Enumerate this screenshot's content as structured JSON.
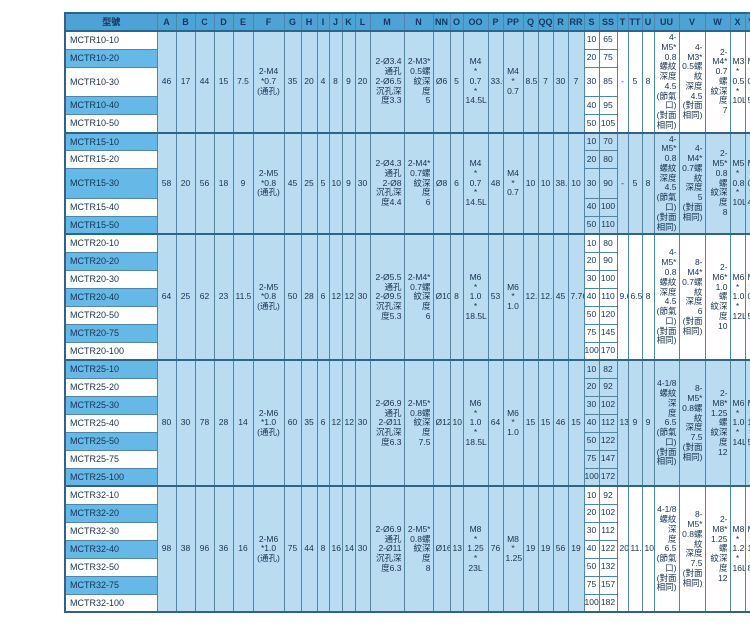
{
  "colors": {
    "header_bg": "#4da3d6",
    "model_row_blue": "#66b9e6",
    "cell_light_blue": "#b9dcf0",
    "cell_white": "#ffffff",
    "border": "#4f85a6",
    "outer_border": "#2f6486",
    "text": "#16324f"
  },
  "table": {
    "model_header": "型號",
    "letter_columns": [
      "A",
      "B",
      "C",
      "D",
      "E",
      "F",
      "G",
      "H",
      "I",
      "J",
      "K",
      "L",
      "M",
      "N",
      "NN",
      "O",
      "OO",
      "P",
      "PP",
      "Q",
      "QQ",
      "R",
      "RR",
      "S",
      "SS",
      "T",
      "TT",
      "U",
      "UU",
      "V",
      "W",
      "X",
      "Y",
      "Z",
      "ZZ"
    ],
    "blocks": [
      {
        "band": "white",
        "shared": {
          "A": "46",
          "B": "17",
          "C": "44",
          "D": "15",
          "E": "7.5",
          "F": "2-M4\n*0.7\n(通孔)",
          "G": "35",
          "H": "20",
          "I": "4",
          "J": "8",
          "K": "9",
          "L": "20",
          "M": "2-Ø3.4\n通孔\n2-Ø6.5\n沉孔深\n度3.3",
          "N": "2-M3*\n0.5螺\n紋深度\n5",
          "NN": "Ø6",
          "O": "5",
          "OO": "M4\n*\n0.7\n*\n14.5L",
          "P": "33.6",
          "PP": "M4\n*\n0.7",
          "Q": "8.5",
          "QQ": "7",
          "R": "30",
          "RR": "7",
          "T": "-",
          "TT": "5",
          "U": "8",
          "UU": "4-M5*\n0.8螺紋\n深度4.5\n(節氣\n口)\n(對面\n相同)",
          "V": "4-M3*\n0.5螺紋\n深度4.5\n(對面\n相同)",
          "W": "2-M4*\n0.7螺\n紋深度\n7",
          "X": "M3\n*\n0.5\n*\n10L",
          "Y": "M3\n*\n0.5\n*\n5L"
        },
        "z_groups": [
          {
            "value": "30",
            "span": 2
          },
          {
            "value": "40",
            "span": 3
          }
        ],
        "rows": [
          {
            "model": "MCTR10-10",
            "S": "10",
            "SS": "65",
            "ZZ": "82"
          },
          {
            "model": "MCTR10-20",
            "S": "20",
            "SS": "75",
            "ZZ": "92"
          },
          {
            "model": "MCTR10-30",
            "S": "30",
            "SS": "85",
            "ZZ": "102"
          },
          {
            "model": "MCTR10-40",
            "S": "40",
            "SS": "95",
            "ZZ": "112"
          },
          {
            "model": "MCTR10-50",
            "S": "50",
            "SS": "105",
            "ZZ": "122"
          }
        ]
      },
      {
        "band": "blue",
        "shared": {
          "A": "58",
          "B": "20",
          "C": "56",
          "D": "18",
          "E": "9",
          "F": "2-M5\n*0.8\n(通孔)",
          "G": "45",
          "H": "25",
          "I": "5",
          "J": "10",
          "K": "9",
          "L": "30",
          "M": "2-Ø4.3\n通孔\n2-Ø8\n沉孔深\n度4.4",
          "N": "2-M4*\n0.7螺\n紋深度\n6",
          "NN": "Ø8",
          "O": "6",
          "OO": "M4\n*\n0.7\n*\n14.5L",
          "P": "48",
          "PP": "M4\n*\n0.7",
          "Q": "10",
          "QQ": "10",
          "R": "38.5",
          "RR": "10",
          "T": "-",
          "TT": "5",
          "U": "8",
          "UU": "4-M5*\n0.8螺紋\n深度4.5\n(節氣\n口)\n(對面\n相同)",
          "V": "4-M4*\n0.7螺紋\n深度5\n(對面\n相同)",
          "W": "2-M5*\n0.8螺\n紋深度\n8",
          "X": "M5\n*\n0.8\n*\n10L",
          "Y": "M4\n*\n0.7\n*\n4L"
        },
        "z_groups": [
          {
            "value": "25",
            "span": 2
          },
          {
            "value": "35",
            "span": 3
          }
        ],
        "rows": [
          {
            "model": "MCTR15-10",
            "S": "10",
            "SS": "70",
            "ZZ": "89"
          },
          {
            "model": "MCTR15-20",
            "S": "20",
            "SS": "80",
            "ZZ": "99"
          },
          {
            "model": "MCTR15-30",
            "S": "30",
            "SS": "90",
            "ZZ": "109"
          },
          {
            "model": "MCTR15-40",
            "S": "40",
            "SS": "100",
            "ZZ": "119"
          },
          {
            "model": "MCTR15-50",
            "S": "50",
            "SS": "110",
            "ZZ": "129"
          }
        ]
      },
      {
        "band": "white",
        "shared": {
          "A": "64",
          "B": "25",
          "C": "62",
          "D": "23",
          "E": "11.5",
          "F": "2-M5\n*0.8\n(通孔)",
          "G": "50",
          "H": "28",
          "I": "6",
          "J": "12",
          "K": "12",
          "L": "30",
          "M": "2-Ø5.5\n通孔\n2-Ø9.5\n沉孔深\n度5.3",
          "N": "2-M4*\n0.7螺\n紋深度\n6",
          "NN": "Ø10",
          "O": "8",
          "OO": "M6\n*\n1.0\n*\n18.5L",
          "P": "53",
          "PP": "M6\n*\n1.0",
          "Q": "12.5",
          "QQ": "12.5",
          "R": "45",
          "RR": "7.76",
          "T": "9.6",
          "TT": "6.5",
          "U": "8",
          "UU": "4-M5*\n0.8螺紋\n深度4.5\n(節氣\n口)\n(對面\n相同)",
          "V": "8-M4*\n0.7螺紋\n深度6\n(對面\n相同)",
          "W": "2-M6*\n1.0螺\n紋深度\n10",
          "X": "M6\n*\n1.0\n*\n12L",
          "Y": "M5\n*\n0.8\n*\n5L"
        },
        "z_groups": [
          {
            "value": "30",
            "span": 2
          },
          {
            "value": "40",
            "span": 3
          },
          {
            "value": "60",
            "span": 2
          }
        ],
        "rows": [
          {
            "model": "MCTR20-10",
            "S": "10",
            "SS": "80",
            "ZZ": "104"
          },
          {
            "model": "MCTR20-20",
            "S": "20",
            "SS": "90",
            "ZZ": "114"
          },
          {
            "model": "MCTR20-30",
            "S": "30",
            "SS": "100",
            "ZZ": "124"
          },
          {
            "model": "MCTR20-40",
            "S": "40",
            "SS": "110",
            "ZZ": "134"
          },
          {
            "model": "MCTR20-50",
            "S": "50",
            "SS": "120",
            "ZZ": "144"
          },
          {
            "model": "MCTR20-75",
            "S": "75",
            "SS": "145",
            "ZZ": "169"
          },
          {
            "model": "MCTR20-100",
            "S": "100",
            "SS": "170",
            "ZZ": "194"
          }
        ]
      },
      {
        "band": "blue",
        "shared": {
          "A": "80",
          "B": "30",
          "C": "78",
          "D": "28",
          "E": "14",
          "F": "2-M6\n*1.0\n(通孔)",
          "G": "60",
          "H": "35",
          "I": "6",
          "J": "12",
          "K": "12",
          "L": "30",
          "M": "2-Ø6.9\n通孔\n2-Ø11\n沉孔深\n度6.3",
          "N": "2-M5*\n0.8螺\n紋深度\n7.5",
          "NN": "Ø12",
          "O": "10",
          "OO": "M6\n*\n1.0\n*\n18.5L",
          "P": "64",
          "PP": "M6\n*\n1.0",
          "Q": "15",
          "QQ": "15",
          "R": "46",
          "RR": "15",
          "T": "13",
          "TT": "9",
          "U": "9",
          "UU": "4-1/8\n螺紋深\n度6.5\n(節氣\n口)\n(對面\n相同)",
          "V": "8-M5*\n0.8螺紋\n深度7.5\n(對面\n相同)",
          "W": "2-M8*\n1.25螺\n紋深度\n12",
          "X": "M6\n*\n1.0\n*\n14L",
          "Y": "M6\n*\n1.0\n*\n5L"
        },
        "z_groups": [
          {
            "value": "30",
            "span": 2
          },
          {
            "value": "40",
            "span": 3
          },
          {
            "value": "60",
            "span": 2
          }
        ],
        "rows": [
          {
            "model": "MCTR25-10",
            "S": "10",
            "SS": "82",
            "ZZ": "106"
          },
          {
            "model": "MCTR25-20",
            "S": "20",
            "SS": "92",
            "ZZ": "116"
          },
          {
            "model": "MCTR25-30",
            "S": "30",
            "SS": "102",
            "ZZ": "126"
          },
          {
            "model": "MCTR25-40",
            "S": "40",
            "SS": "112",
            "ZZ": "136"
          },
          {
            "model": "MCTR25-50",
            "S": "50",
            "SS": "122",
            "ZZ": "146"
          },
          {
            "model": "MCTR25-75",
            "S": "75",
            "SS": "147",
            "ZZ": "171"
          },
          {
            "model": "MCTR25-100",
            "S": "100",
            "SS": "172",
            "ZZ": "194"
          }
        ]
      },
      {
        "band": "white",
        "shared": {
          "A": "98",
          "B": "38",
          "C": "96",
          "D": "36",
          "E": "16",
          "F": "2-M6\n*1.0\n(通孔)",
          "G": "75",
          "H": "44",
          "I": "8",
          "J": "16",
          "K": "14",
          "L": "30",
          "M": "2-Ø6.9\n通孔\n2-Ø11\n沉孔深\n度6.3",
          "N": "2-M5*\n0.8螺\n紋深度\n8",
          "NN": "Ø16",
          "O": "13",
          "OO": "M8\n*\n1.25\n*\n23L",
          "P": "76",
          "PP": "M8\n*\n1.25",
          "Q": "19",
          "QQ": "19",
          "R": "56",
          "RR": "19",
          "T": "20",
          "TT": "11.5",
          "U": "10",
          "UU": "4-1/8\n螺紋深\n度6.5\n(節氣\n口)\n(對面\n相同)",
          "V": "8-M5*\n0.8螺紋\n深度7.5\n(對面\n相同)",
          "W": "2-M8*\n1.25螺\n紋深度\n12",
          "X": "M8\n*\n1.25\n*\n16L",
          "Y": "M8\n*\n1.25\n*\n8L"
        },
        "z_groups": [
          {
            "value": "40",
            "span": 2
          },
          {
            "value": "50",
            "span": 3
          },
          {
            "value": "70",
            "span": 2
          }
        ],
        "rows": [
          {
            "model": "MCTR32-10",
            "S": "10",
            "SS": "92",
            "ZZ": "122"
          },
          {
            "model": "MCTR32-20",
            "S": "20",
            "SS": "102",
            "ZZ": "132"
          },
          {
            "model": "MCTR32-30",
            "S": "30",
            "SS": "112",
            "ZZ": "142"
          },
          {
            "model": "MCTR32-40",
            "S": "40",
            "SS": "122",
            "ZZ": "152"
          },
          {
            "model": "MCTR32-50",
            "S": "50",
            "SS": "132",
            "ZZ": "162"
          },
          {
            "model": "MCTR32-75",
            "S": "75",
            "SS": "157",
            "ZZ": "187"
          },
          {
            "model": "MCTR32-100",
            "S": "100",
            "SS": "182",
            "ZZ": "212"
          }
        ]
      }
    ]
  }
}
